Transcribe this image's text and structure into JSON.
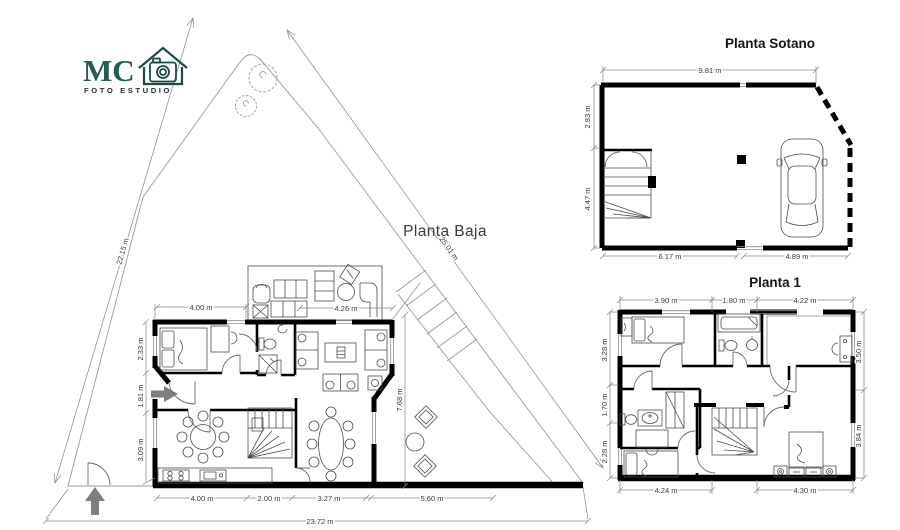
{
  "logo": {
    "initials": "MC",
    "subtitle": "FOTO ESTUDIO",
    "accent_color": "#255c54"
  },
  "plans": {
    "lot": {
      "dim_left": "22.15 m",
      "dim_diagonal": "25.01 m",
      "dim_bottom": "23.72 m"
    },
    "baja": {
      "title": "Planta Baja",
      "dim_top_1": "4.00 m",
      "dim_top_2": "4.26 m",
      "dim_left_1": "2.33 m",
      "dim_left_2": "1.81 m",
      "dim_left_3": "3.09 m",
      "dim_right_1": "7.68 m",
      "dim_bottom_1": "4.00 m",
      "dim_bottom_2": "2.00 m",
      "dim_bottom_3": "3.27 m",
      "dim_bottom_4": "5.60 m"
    },
    "sotano": {
      "title": "Planta Sotano",
      "dim_top_1": "9.81 m",
      "dim_left_1": "2.83 m",
      "dim_left_2": "4.47 m",
      "dim_bottom_1": "6.17 m",
      "dim_bottom_2": "4.89 m"
    },
    "planta1": {
      "title": "Planta 1",
      "dim_top_1": "3.90 m",
      "dim_top_2": "1.80 m",
      "dim_top_3": "4.22 m",
      "dim_left_1": "3.28 m",
      "dim_left_2": "1.70 m",
      "dim_left_3": "2.28 m",
      "dim_right_1": "3.50 m",
      "dim_right_2": "3.84 m",
      "dim_bottom_1": "4.24 m",
      "dim_bottom_2": "4.30 m"
    }
  },
  "colors": {
    "wall": "#000000",
    "lot_line": "#9a9a9a",
    "arrow": "#7f7f7f",
    "dim_text": "#3a3a3a"
  }
}
